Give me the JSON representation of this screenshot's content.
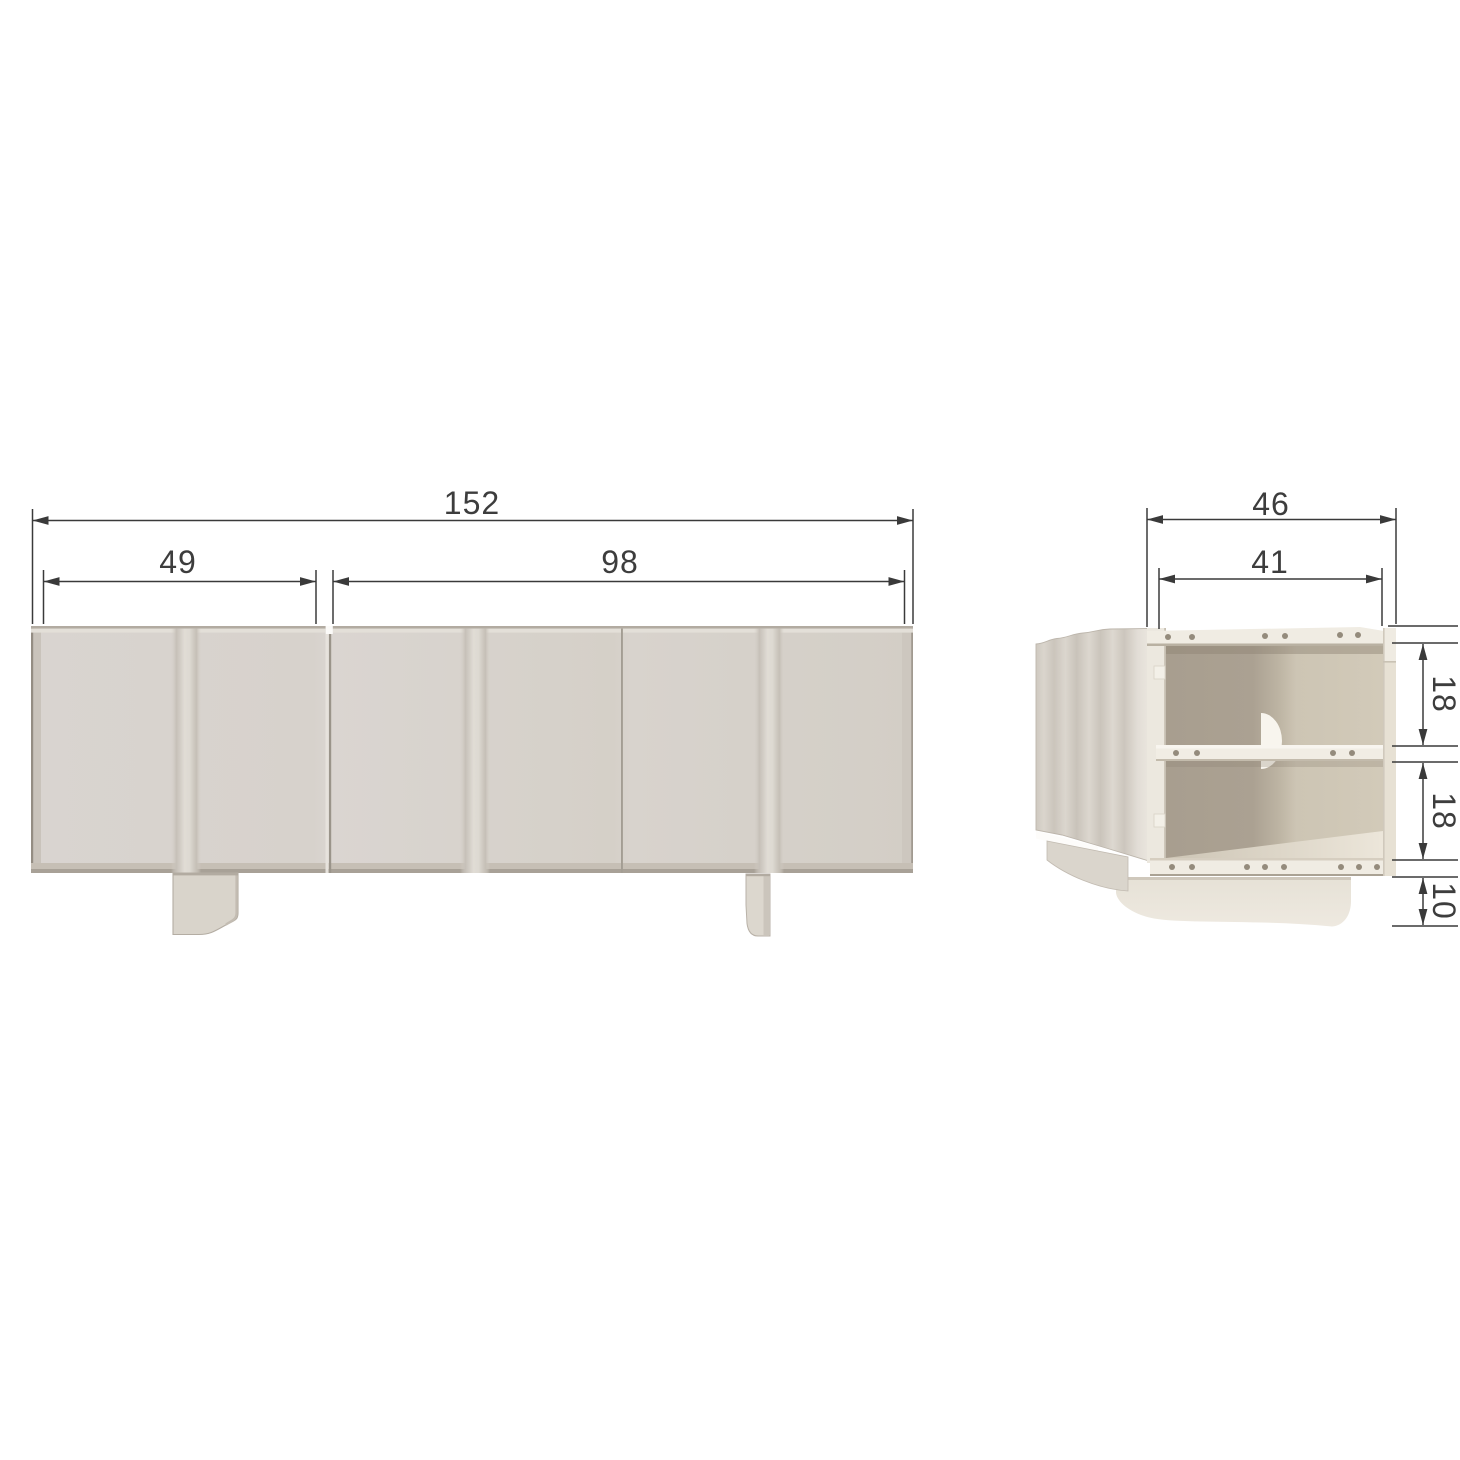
{
  "drawing": {
    "subject": "sideboard-technical-dimension-drawing",
    "front_view": {
      "dimensions": {
        "total_width": "152",
        "left_door_width": "49",
        "double_door_width": "98"
      }
    },
    "side_view": {
      "dimensions": {
        "total_depth": "46",
        "inner_depth": "41",
        "upper_compartment_height": "18",
        "lower_compartment_height": "18",
        "leg_height": "10"
      }
    },
    "colors": {
      "background": "#ffffff",
      "cabinet_face": "#d8d3cb",
      "panel_light": "#f0ece3",
      "interior_dark": "#a89e8f",
      "interior_light": "#cdc5b4",
      "base_cream": "#e9e4da",
      "dimension_line": "#3e3e3e"
    }
  }
}
